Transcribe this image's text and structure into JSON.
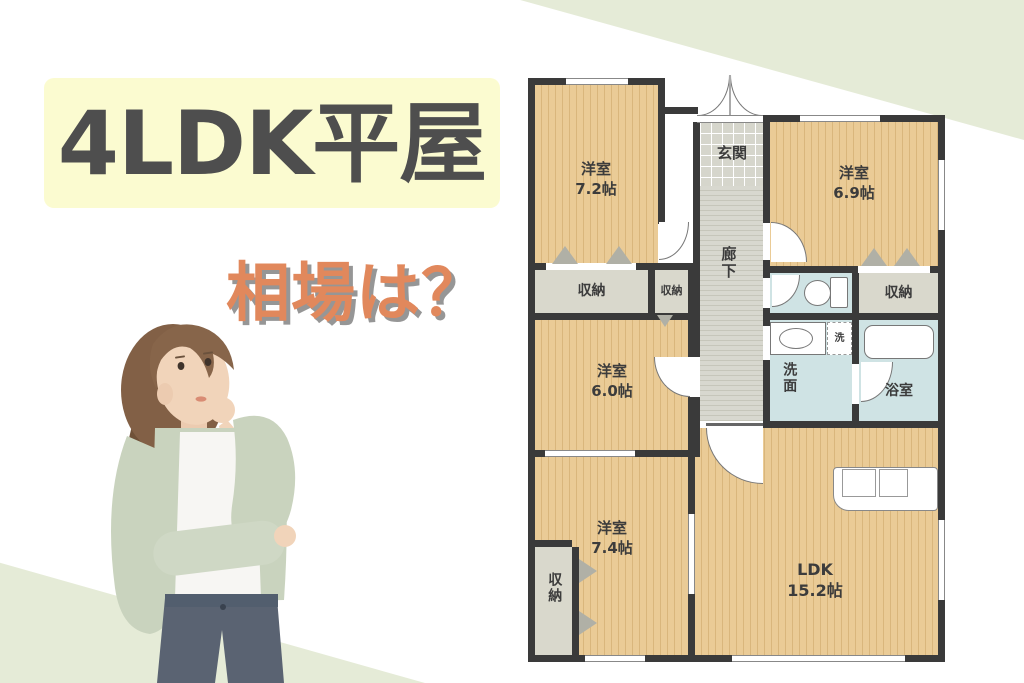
{
  "title": "4LDK平屋",
  "subtitle": "相場は？",
  "floorplan": {
    "labels": {
      "closet": "収納",
      "entrance": "玄関",
      "hallway": "廊下",
      "washroom": "洗面",
      "bathroom": "浴室",
      "washer": "洗"
    },
    "rooms": {
      "bedroom1": {
        "name": "洋室",
        "size": "7.2帖"
      },
      "bedroom2": {
        "name": "洋室",
        "size": "6.9帖"
      },
      "bedroom3": {
        "name": "洋室",
        "size": "6.0帖"
      },
      "bedroom4": {
        "name": "洋室",
        "size": "7.4帖"
      },
      "ldk": {
        "name": "LDK",
        "size": "15.2帖"
      }
    }
  },
  "colors": {
    "accent_green": "#e5ebd7",
    "title_bg": "#fbfbd0",
    "title_text": "#4e4e4e",
    "subtitle_text": "#e1885c",
    "wood_floor": "#eacb96",
    "wall": "#3a3a3a",
    "water_room": "#cfe3e4",
    "closet_gray": "#d9d8cc"
  }
}
